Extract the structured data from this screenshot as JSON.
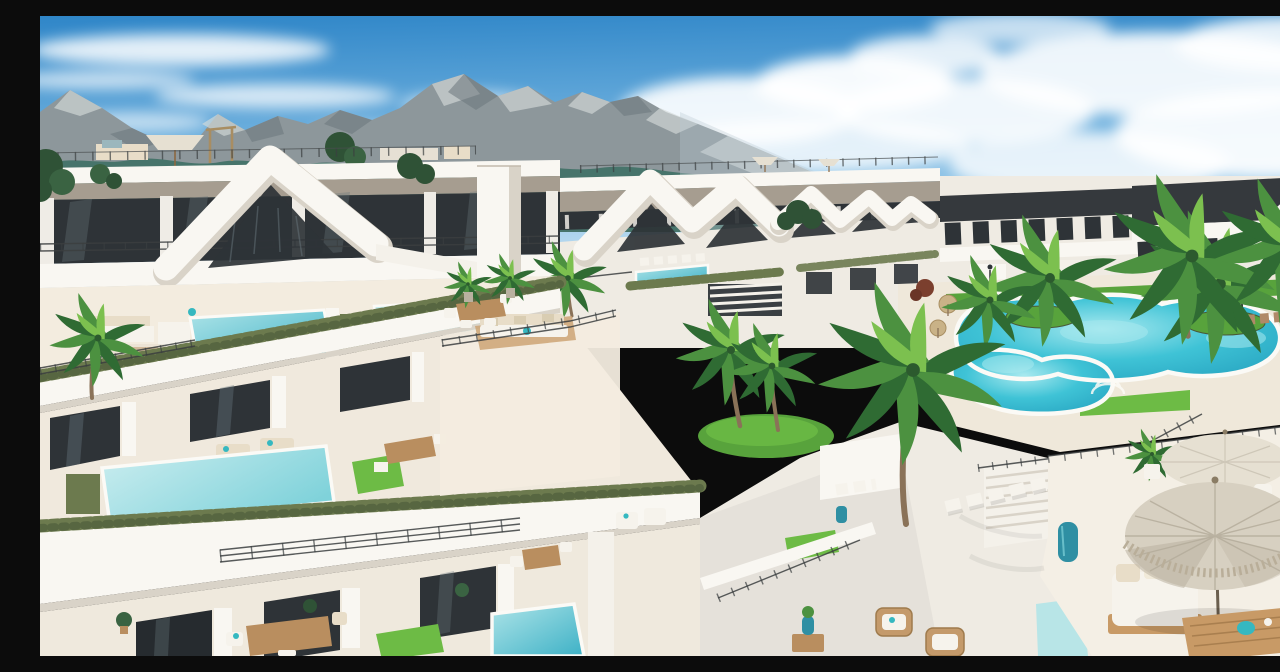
{
  "scene": {
    "description": "Aerial 3D architectural render of a sunny modern white terraced apartment complex. Stepped balconies with private turquoise plunge pools, clipped hedges and glass balustrades descend from upper left to lower right. Distinctive white wave- and zigzag-shaped parapet ribbons crown the facades. A free-form communal lagoon pool with grass islands and tall palm trees sits on the right. In the foreground a rooftop terrace has a large fringed canvas parasol, a pale umbrella with a drinks table, daybeds, wicker chairs and teal ceramic planters. A rugged grey mountain range with teal vegetation rises behind the buildings under a blue sky with white clouds.",
    "setting": "daytime, bright Mediterranean sunlight",
    "sky": "blue with streaky and cumulus white clouds",
    "features": [
      "mountain-range",
      "distant-hills",
      "treeline",
      "apartment-buildings",
      "wave-parapet",
      "zigzag-roofline",
      "roof-terraces",
      "glass-balustrades",
      "metal-railings",
      "hedges",
      "lawns",
      "private-plunge-pools",
      "rooftop-lap-pool",
      "communal-lagoon-pool",
      "grass-islands",
      "palm-trees",
      "straw-umbrellas",
      "fringed-parasol",
      "pale-umbrella",
      "daybed",
      "sun-loungers",
      "dining-sets",
      "wicker-chairs",
      "teal-ceramic-planters",
      "wood-deck-tables",
      "exterior-stairs",
      "lamp-posts"
    ],
    "approx_counts": {
      "private_pools_visible": 7,
      "communal_pools": 1,
      "palm_trees_major": 11,
      "umbrellas_and_parasols": 5,
      "terrace_levels_foreground": 3
    }
  },
  "palette": {
    "sky_top": "#2f86c8",
    "sky_mid": "#7ab8e2",
    "sky_horizon": "#ddeef8",
    "cloud_white": "#ffffff",
    "mountain_rock": "#8d979b",
    "mountain_light": "#d4dad9",
    "mountain_shadow": "#6b767b",
    "mountain_teal": "#3f7066",
    "mountain_teal_dark": "#2c5a52",
    "mountain_green": "#4d7c5c",
    "haze_blue": "#b9c8d2",
    "hills_far": "#c3ced5",
    "treeline_green": "#47663f",
    "white_sunlit": "#f9f7f2",
    "white_base": "#efebe3",
    "white_shadow": "#d9d3c8",
    "deep_shadow": "#c2baac",
    "taupe_fascia": "#a69d90",
    "dark_fascia": "#35393d",
    "glass_dark": "#2e3337",
    "glass_reflection": "#67757c",
    "railing_dark": "#3b3e40",
    "hedge_green": "#6c7a4e",
    "hedge_dark": "#4a5838",
    "lawn_green": "#58a33c",
    "lawn_bright": "#6dbb45",
    "pool_edge_light": "#a8e9ef",
    "pool_mid": "#3fc3d6",
    "pool_deep": "#239fbd",
    "private_pool_light": "#aee4e8",
    "private_pool_deep": "#3db1c6",
    "paving_light": "#efe8da",
    "paving_warm": "#f3ecdf",
    "wood_warm": "#b98e5f",
    "wood_dark": "#8d6840",
    "deck_wood": "#c89a66",
    "cushion_beige": "#e8ddc8",
    "cushion_white": "#f6f3ec",
    "umbrella_canvas": "#d7d0c1",
    "umbrella_shade": "#b9b1a0",
    "umbrella_pale": "#e6e0d2",
    "straw_tan": "#c9b287",
    "planter_teal": "#2f8fa3",
    "accent_teal": "#35b8c0",
    "shrub_red": "#7b3f2e",
    "palm_trunk": "#8a7258",
    "palm_dark": "#2f6b33",
    "palm_mid": "#4c9140",
    "palm_light": "#7cc04f",
    "tree_dark": "#2f5236"
  }
}
